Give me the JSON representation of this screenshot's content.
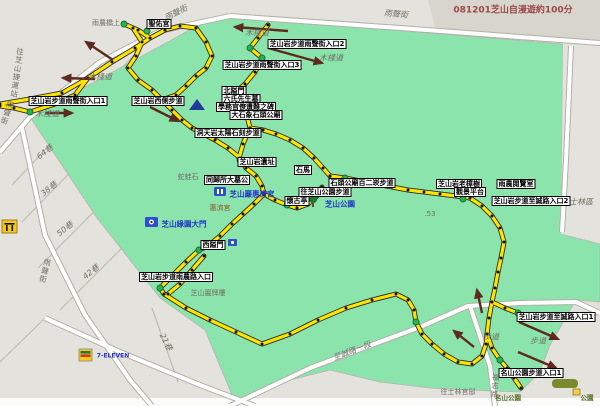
{
  "title": "081201芝山自漫遊約100分",
  "colors": {
    "park_green": "#8ce4ad",
    "block_gray": "#e4e2dc",
    "title_block_gray": "#d8d5cd",
    "road_white": "#ffffff",
    "road_casing": "#b4b0a8",
    "route_yellow": "#ffe400",
    "route_casing": "#2b2b2b",
    "dot_black": "#141414",
    "marker_green": "#2fae55",
    "arrow_maroon": "#5f2a1e",
    "label_box_bg": "#ffffff",
    "poi_blue": "#2035c8",
    "title_red": "#9a4a4a"
  },
  "labels": [
    {
      "name": "map-title",
      "text": "081201芝山自漫遊約100分",
      "cls": "title-t",
      "x": 513,
      "y": 9
    },
    {
      "name": "street-yusheng-1",
      "text": "雨聲街",
      "cls": "gray-rot",
      "x": 176,
      "y": 13,
      "rot": -27
    },
    {
      "name": "street-yusheng-2",
      "text": "雨聲街",
      "cls": "gray-rot",
      "x": 396,
      "y": 14,
      "rot": 5
    },
    {
      "name": "to-zhishan-mrt",
      "text": "往芝山捷運站",
      "cls": "gray-vert",
      "x": 17,
      "y": 73,
      "rot": 8
    },
    {
      "name": "street-yusheng-3",
      "text": "雨聲街",
      "cls": "gray-vert",
      "x": 7,
      "y": 113,
      "rot": 18
    },
    {
      "name": "street-yusheng-4",
      "text": "雨聲街",
      "cls": "gray-vert",
      "x": 45,
      "y": 271,
      "rot": 14
    },
    {
      "name": "lane-64",
      "text": "64巷",
      "cls": "gray-rot",
      "x": 45,
      "y": 152,
      "rot": -38
    },
    {
      "name": "lane-38",
      "text": "38巷",
      "cls": "gray-rot",
      "x": 49,
      "y": 189,
      "rot": -38
    },
    {
      "name": "lane-50",
      "text": "50巷",
      "cls": "gray-rot",
      "x": 65,
      "y": 229,
      "rot": -38
    },
    {
      "name": "lane-42",
      "text": "42巷",
      "cls": "gray-rot",
      "x": 91,
      "y": 272,
      "rot": -38
    },
    {
      "name": "lane-21",
      "text": "21巷",
      "cls": "gray-rot",
      "x": 166,
      "y": 342,
      "rot": 62
    },
    {
      "name": "boardwalk-1",
      "text": "木棧道",
      "cls": "gray-i",
      "x": 100,
      "y": 77
    },
    {
      "name": "boardwalk-2",
      "text": "木棧道",
      "cls": "gray-i",
      "x": 47,
      "y": 114
    },
    {
      "name": "boardwalk-3",
      "text": "木棧道",
      "cls": "gray-i",
      "x": 257,
      "y": 33
    },
    {
      "name": "boardwalk-4",
      "text": "木棧道",
      "cls": "gray-i",
      "x": 331,
      "y": 58
    },
    {
      "name": "bridge-note",
      "text": "雨農橋上",
      "cls": "gray-s",
      "x": 106,
      "y": 23
    },
    {
      "name": "shengyou-temple",
      "text": "聖佑宮",
      "cls": "box",
      "x": 159,
      "y": 24
    },
    {
      "name": "entrance-yusheng-2",
      "text": "芝山岩步道雨聲街入口2",
      "cls": "box",
      "x": 307,
      "y": 44
    },
    {
      "name": "entrance-yusheng-3",
      "text": "芝山岩步道雨聲街入口3",
      "cls": "box",
      "x": 262,
      "y": 65
    },
    {
      "name": "entrance-yusheng-1",
      "text": "芝山岩步道雨聲街入口1",
      "cls": "box",
      "x": 68,
      "y": 101
    },
    {
      "name": "west-trail",
      "text": "芝山岩西側步道",
      "cls": "box",
      "x": 158,
      "y": 101
    },
    {
      "name": "north-gate",
      "text": "北隘門",
      "cls": "box",
      "x": 234,
      "y": 91
    },
    {
      "name": "six-teachers-tomb",
      "text": "六氏先生墓",
      "cls": "box",
      "x": 241,
      "y": 99
    },
    {
      "name": "gakumu-monument",
      "text": "學務官僚遭難之碑",
      "cls": "box",
      "x": 246,
      "y": 107
    },
    {
      "name": "stone-elephant",
      "text": "大石象石頭公廟",
      "cls": "box",
      "x": 256,
      "y": 115
    },
    {
      "name": "dongtian-rock",
      "text": "洞天岩太陽石刻步道",
      "cls": "box",
      "x": 228,
      "y": 133
    },
    {
      "name": "zhishan-site",
      "text": "芝山岩遺址",
      "cls": "box",
      "x": 257,
      "y": 162
    },
    {
      "name": "snake-frog-rock",
      "text": "蛇蛙石",
      "cls": "gray-s",
      "x": 188,
      "y": 177
    },
    {
      "name": "tonggui-tomb",
      "text": "同歸所大墓公",
      "cls": "box",
      "x": 227,
      "y": 180
    },
    {
      "name": "huiji-temple-poi",
      "text": "芝山巖惠濟宮",
      "cls": "blue",
      "x": 252,
      "y": 194
    },
    {
      "name": "huiji-temple",
      "text": "惠濟宮",
      "cls": "brown",
      "x": 220,
      "y": 208
    },
    {
      "name": "huaigu-pavilion",
      "text": "懷古亭",
      "cls": "box",
      "x": 297,
      "y": 201
    },
    {
      "name": "stone-horse",
      "text": "石馬",
      "cls": "box",
      "x": 303,
      "y": 170
    },
    {
      "name": "east-trail-1",
      "text": "石頭公廟百二崁步道",
      "cls": "box",
      "x": 362,
      "y": 183
    },
    {
      "name": "east-trail-2",
      "text": "往芝山公園步道",
      "cls": "box",
      "x": 325,
      "y": 192
    },
    {
      "name": "zhishan-park-poi",
      "text": "芝山公園",
      "cls": "blue",
      "x": 340,
      "y": 204
    },
    {
      "name": "elevation-53",
      "text": ".53",
      "cls": "gray-s",
      "x": 430,
      "y": 214
    },
    {
      "name": "old-camphor-trees",
      "text": "芝山岩老樟樹",
      "cls": "box",
      "x": 459,
      "y": 184
    },
    {
      "name": "lookout",
      "text": "觀景平台",
      "cls": "box",
      "x": 470,
      "y": 192
    },
    {
      "name": "yunong-reading-room",
      "text": "雨農閱覽室",
      "cls": "box",
      "x": 516,
      "y": 184
    },
    {
      "name": "entrance-zhicheng-2",
      "text": "芝山岩步道至誠路入口2",
      "cls": "box",
      "x": 531,
      "y": 201
    },
    {
      "name": "shilin-district",
      "text": "士林區",
      "cls": "gray-i",
      "x": 581,
      "y": 202
    },
    {
      "name": "entrance-zhicheng-1",
      "text": "芝山岩步道至誠路入口1",
      "cls": "box",
      "x": 556,
      "y": 317
    },
    {
      "name": "path-1",
      "text": "步道",
      "cls": "gray-i",
      "x": 491,
      "y": 337
    },
    {
      "name": "path-2",
      "text": "步道",
      "cls": "gray-i",
      "x": 538,
      "y": 341
    },
    {
      "name": "entrance-mingshan",
      "text": "名山公園步道入口1",
      "cls": "box",
      "x": 531,
      "y": 373
    },
    {
      "name": "to-shilin-residence",
      "text": "往士林官邸",
      "cls": "gray-s",
      "x": 458,
      "y": 392
    },
    {
      "name": "fuzhi-road",
      "text": "福志路",
      "cls": "gray-vert",
      "x": 495,
      "y": 386,
      "rot": 5
    },
    {
      "name": "mingshan-park",
      "text": "名山公園",
      "cls": "green-s",
      "x": 508,
      "y": 397
    },
    {
      "name": "park-corner",
      "text": "公園",
      "cls": "green-s",
      "x": 587,
      "y": 397
    },
    {
      "name": "west-gate",
      "text": "西隘門",
      "cls": "box",
      "x": 213,
      "y": 245
    },
    {
      "name": "entrance-yunong",
      "text": "芝山岩步道雨農路入口",
      "cls": "box",
      "x": 176,
      "y": 277
    },
    {
      "name": "pailou-archway",
      "text": "芝山巖牌樓",
      "cls": "gray-s",
      "x": 208,
      "y": 293
    },
    {
      "name": "green-garden-gate",
      "text": "芝山綠園大門",
      "cls": "blue",
      "x": 184,
      "y": 224
    },
    {
      "name": "zhicheng-road",
      "text": "至誠路一段",
      "cls": "gray-rot",
      "x": 352,
      "y": 351,
      "rot": -21
    },
    {
      "name": "seven-eleven",
      "text": "7-ELEVEN",
      "cls": "blue-s",
      "x": 113,
      "y": 356
    }
  ],
  "map": {
    "route_segments": [
      "0,104 30,99 62,93 88,78 112,62 135,48 150,38 165,30 180,26 196,28",
      "150,38 138,30 124,24",
      "165,30 158,22",
      "133,28 142,42 136,56 128,68 138,80 152,90 162,100",
      "196,28 206,42 212,56 206,68 196,76 186,86 176,95 162,100",
      "162,100 172,110 182,120 192,128 200,132",
      "0,106 14,108 30,112",
      "30,112 55,104 75,95 88,78",
      "268,25 258,38 250,48 262,58 255,72 245,84 236,92",
      "236,92 242,104 247,116 250,128",
      "250,128 243,144 239,158 246,168 256,176 262,186 264,194",
      "200,132 215,140 228,148 240,158",
      "250,128 263,130 276,134 290,140 303,148 314,158 323,168 330,176",
      "330,176 345,178 360,181 376,184 392,187 408,190 424,192 440,194 456,196 470,198",
      "470,198 482,206 492,216 500,228 504,242 501,258 498,272 495,288 492,302 489,318 487,334 492,348 500,360 507,368 514,378 521,388",
      "492,302 505,308 518,313",
      "264,194 275,200 287,205 297,208",
      "297,208 308,204 317,196 322,187",
      "264,194 254,204 243,214 232,224 220,236 208,246 199,250",
      "199,250 186,262 172,276 160,288",
      "204,256 192,270 180,284 168,294",
      "160,288 164,294",
      "164,294 186,308 210,320 236,332 262,344 290,334 318,320 346,308 372,300 396,294 408,300 414,310 416,322 422,334 432,344 444,354 458,362 472,364 482,356 486,344 487,334"
    ],
    "green_markers": [
      [
        124,
        24
      ],
      [
        147,
        31
      ],
      [
        250,
        48
      ],
      [
        262,
        58
      ],
      [
        30,
        112
      ],
      [
        247,
        116
      ],
      [
        240,
        160
      ],
      [
        287,
        205
      ],
      [
        345,
        178
      ],
      [
        463,
        199
      ],
      [
        199,
        250
      ],
      [
        160,
        288
      ],
      [
        416,
        322
      ],
      [
        500,
        360
      ],
      [
        518,
        313
      ]
    ],
    "arrows": [
      [
        113,
        60,
        86,
        42
      ],
      [
        95,
        79,
        63,
        78
      ],
      [
        45,
        113,
        72,
        113
      ],
      [
        288,
        31,
        235,
        27
      ],
      [
        268,
        48,
        322,
        63
      ],
      [
        150,
        107,
        178,
        121
      ],
      [
        474,
        347,
        454,
        331
      ],
      [
        519,
        322,
        558,
        339
      ],
      [
        518,
        352,
        556,
        368
      ],
      [
        482,
        313,
        477,
        290
      ]
    ]
  }
}
